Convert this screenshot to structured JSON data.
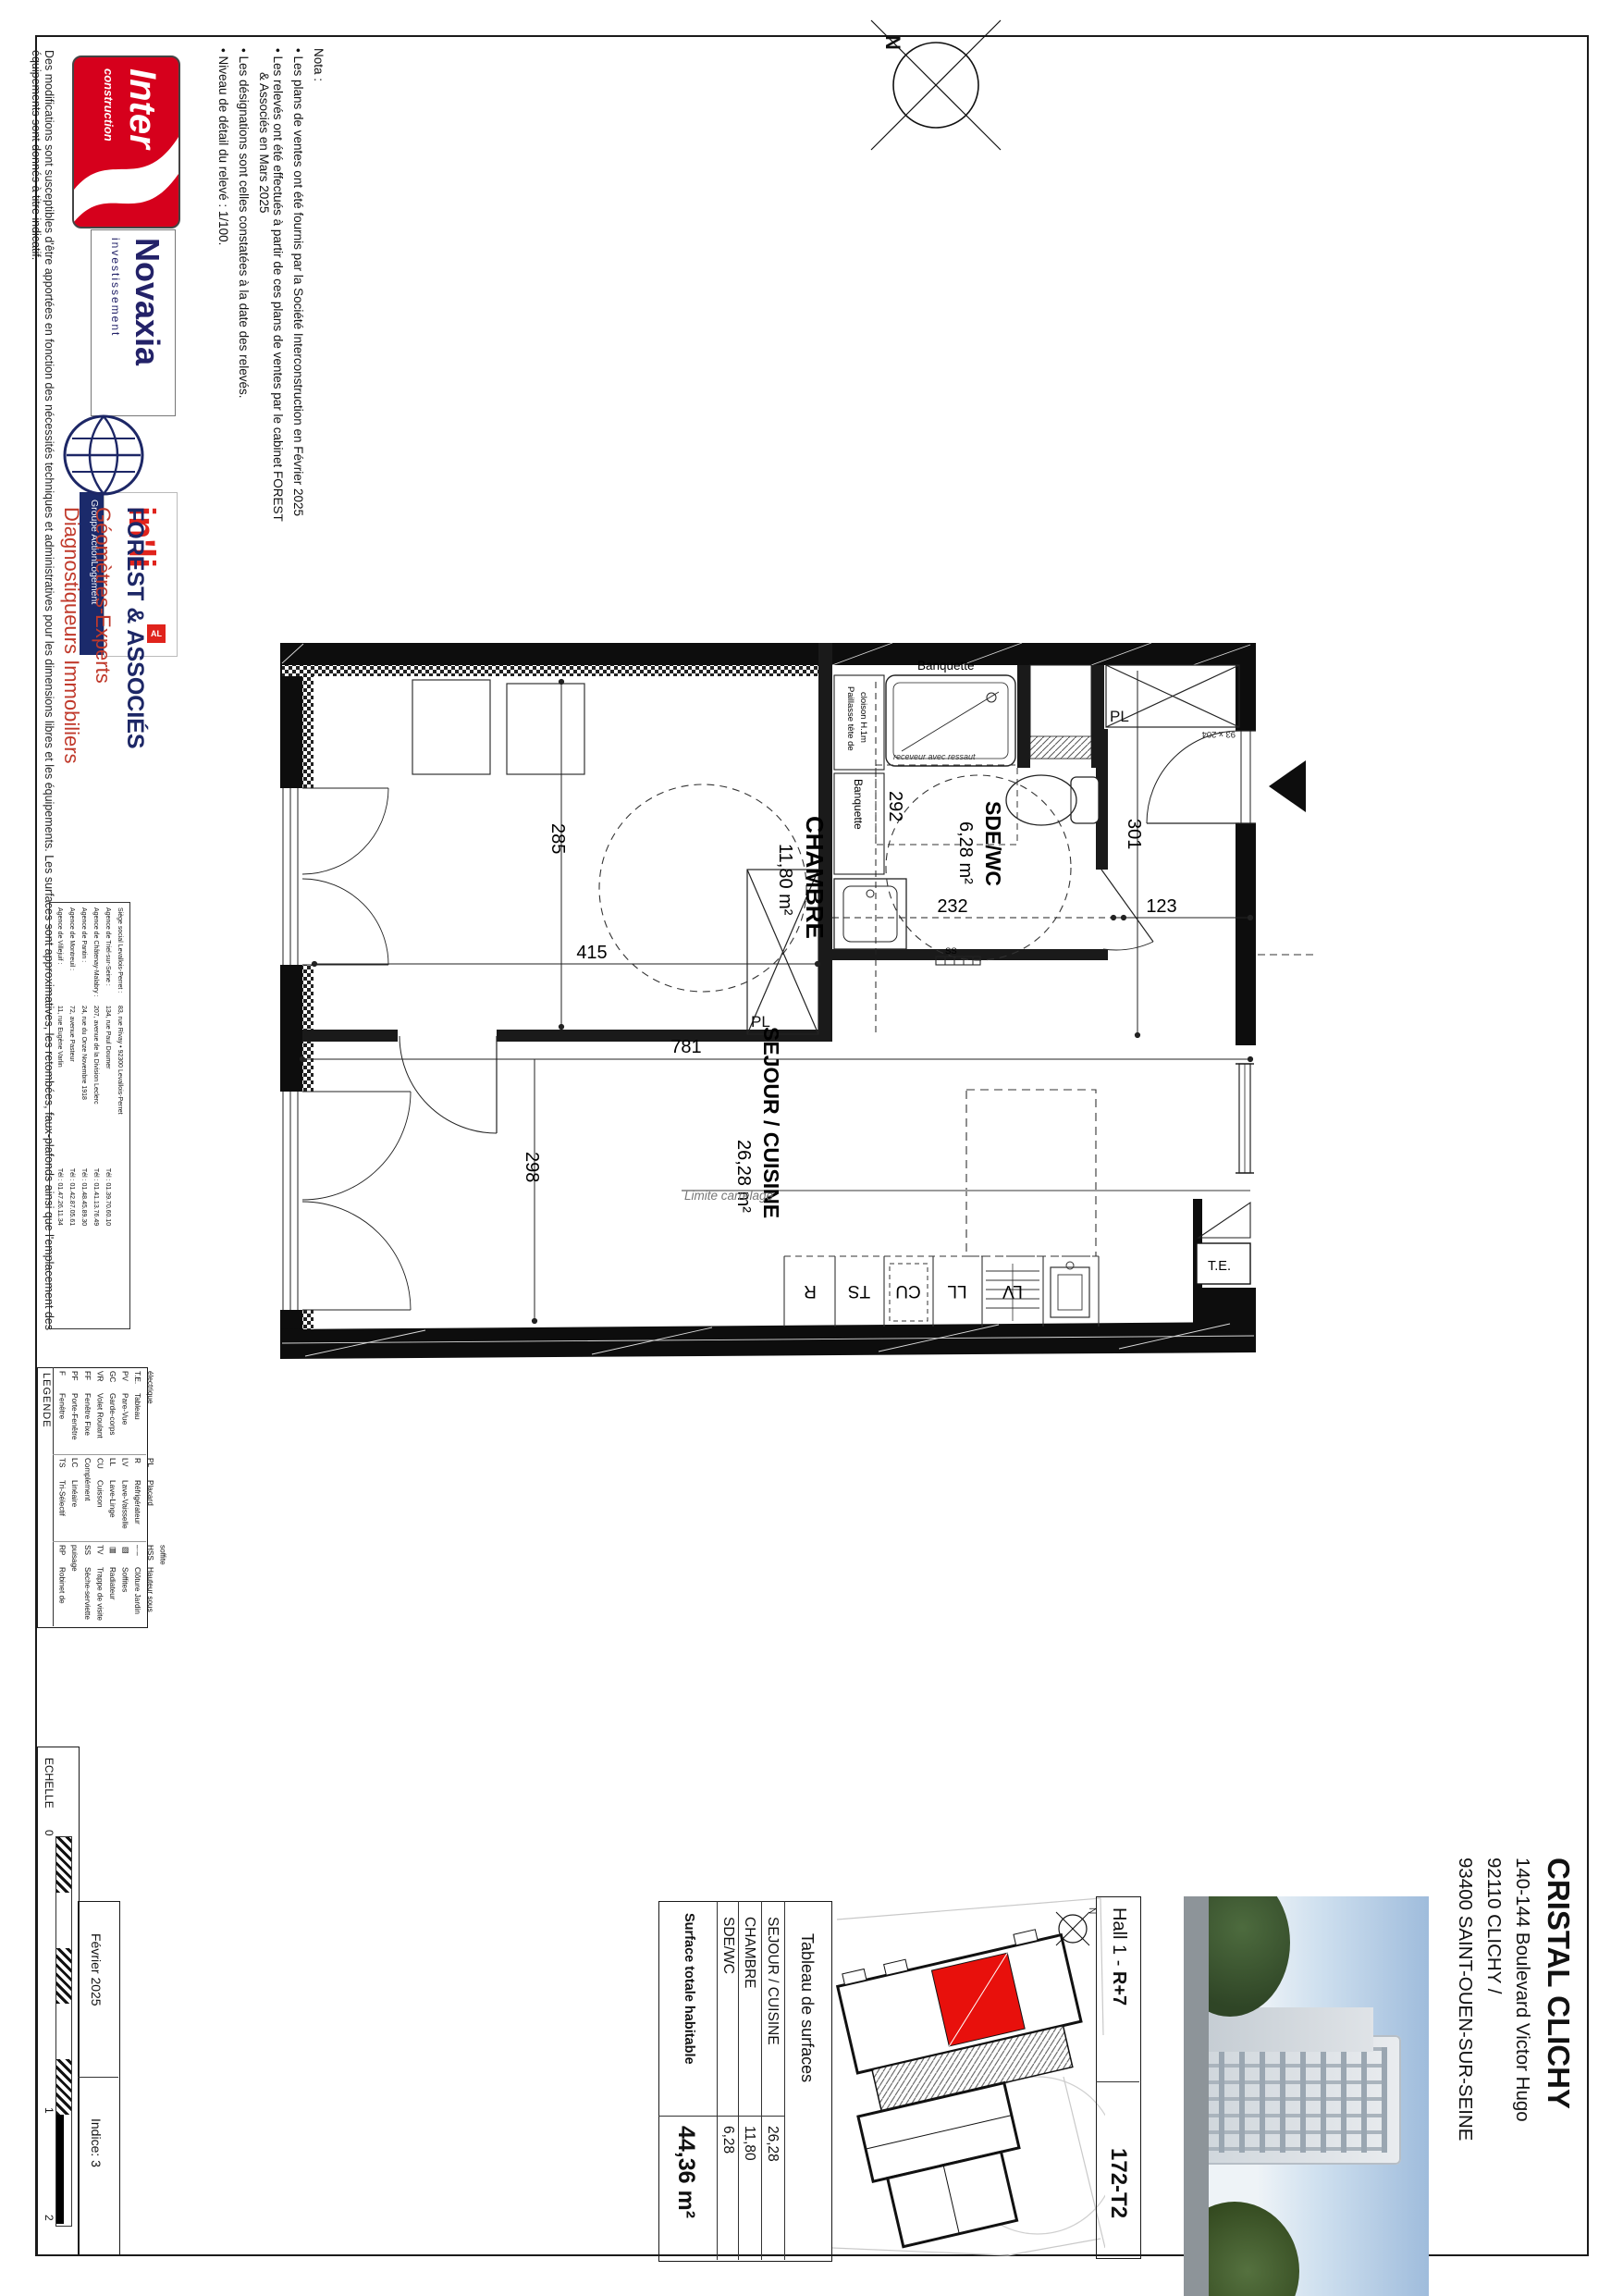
{
  "page": {
    "disclaimer": "Des modifications sont susceptibles d'être apportées en fonction des nécessités techniques et administratives pour les dimensions libres et les équipements. Les surfaces sont approximatives, les retombées, faux-plafonds ainsi que l'emplacement des équipements sont donnés à titre indicatif.",
    "scale_label": "ECHELLE",
    "scale_ticks": {
      "t0": "0",
      "t1": "1",
      "t2": "2"
    },
    "date": "Février 2025",
    "indice": "Indice: 3"
  },
  "logos": {
    "inter": {
      "line1": "Inter",
      "line2": "construction"
    },
    "novaxia": {
      "name": "Novaxia",
      "sub": "investissement"
    },
    "inli": {
      "name": "in'li",
      "al": "AL",
      "group": "Groupe ActionLogement"
    }
  },
  "nota": {
    "title": "Nota :",
    "b1": "•  Les plans de ventes ont été fournis par la Société Interconstruction en Février 2025",
    "b2a": "•  Les relevés ont été effectués à partir de ces plans de ventes par le cabinet FOREST",
    "b2b": "& Associés en Mars 2025",
    "b3": "•  Les désignations sont celles constatées à la date des relevés.",
    "b4": "•  Niveau de détail du relevé : 1/100."
  },
  "forest": {
    "name": "FOREST & ASSOCIÉS",
    "spec1": "Géomètres-Experts",
    "spec2": "Diagnostiqueurs Immobiliers",
    "agencies": [
      {
        "name": "Siège social Levallois-Perret :",
        "addr": "83, rue Rivay • 92300 Levallois-Perret",
        "tel": ""
      },
      {
        "name": "Agence de Triel-sur-Seine :",
        "addr": "134, rue Paul Doumer",
        "tel": "Tél :  01.39.70.60.10"
      },
      {
        "name": "Agence de Châtenay-Malabry :",
        "addr": "207, avenue de la Division Leclerc",
        "tel": "Tél :  01.41.13.76.49"
      },
      {
        "name": "Agence de Pantin :",
        "addr": "24, rue du Onze Novembre 1918",
        "tel": "Tél :  01.48.45.89.30"
      },
      {
        "name": "Agence de Montreuil :",
        "addr": "72, avenue Pasteur",
        "tel": "Tél :  01.42.87.05.61"
      },
      {
        "name": "Agence de Villejuif :",
        "addr": "11, rue Eugène Varlin",
        "tel": "Tél :  01.47.26.11.34"
      }
    ]
  },
  "legend": {
    "title": "LEGENDE",
    "g1": [
      {
        "a": "F",
        "n": "Fenêtre"
      },
      {
        "a": "PF",
        "n": "Porte-Fenêtre"
      },
      {
        "a": "FF",
        "n": "Fenêtre Fixe"
      },
      {
        "a": "VR",
        "n": "Volet Roulant"
      },
      {
        "a": "GC",
        "n": "Garde-corps"
      },
      {
        "a": "PV",
        "n": "Pare-Vue"
      },
      {
        "a": "T.E.",
        "n": "Tableau électrique"
      }
    ],
    "g2": [
      {
        "a": "TS",
        "n": "Tri-Sélectif"
      },
      {
        "a": "LC",
        "n": "Linéaire Complément"
      },
      {
        "a": "CU",
        "n": "Cuisson"
      },
      {
        "a": "LL",
        "n": "Lave-Linge"
      },
      {
        "a": "LV",
        "n": "Lave-Vaisselle"
      },
      {
        "a": "R",
        "n": "Réfrigérateur"
      },
      {
        "a": "PL",
        "n": "Placard"
      }
    ],
    "g3": [
      {
        "a": "RP",
        "n": "Robinet de puisage"
      },
      {
        "a": "SS",
        "n": "Sèche-serviette"
      },
      {
        "a": "TV",
        "n": "Trappe de visite"
      },
      {
        "a": "▤",
        "n": "Radiateur"
      },
      {
        "a": "▨",
        "n": "Soffites"
      },
      {
        "a": "–·–",
        "n": "Clôture Jardin"
      },
      {
        "a": "HSS",
        "n": "Hauteur sous soffite"
      }
    ]
  },
  "plan": {
    "rooms": {
      "chambre": {
        "name": "CHAMBRE",
        "area": "11,80 m²"
      },
      "sde": {
        "name": "SDE/WC",
        "area": "6,28 m²"
      },
      "sejour": {
        "name": "SEJOUR / CUISINE",
        "area": "26,28 m²"
      }
    },
    "dims": {
      "d285": "285",
      "d415": "415",
      "d292": "292",
      "d232": "232",
      "d123": "123",
      "d301": "301",
      "d781": "781",
      "d298": "298"
    },
    "labels": {
      "banquette_h": "Banquette",
      "banquette_v": "Banquette",
      "receveur": "receveur avec ressaut",
      "paillasse1": "Paillasse tête de",
      "paillasse2": "cloison H.1m",
      "limite": "Limite carrelage",
      "pl_entree": "PL",
      "pl_chambre": "PL",
      "te": "T.E.",
      "door_size": "93 x 204",
      "ss": "SS"
    },
    "appliances": [
      "R",
      "TS",
      "CU",
      "LL",
      "LV"
    ]
  },
  "surfaces": {
    "title": "Tableau de surfaces",
    "rows": [
      {
        "name": "SEJOUR / CUISINE",
        "value": "26,28"
      },
      {
        "name": "CHAMBRE",
        "value": "11,80"
      },
      {
        "name": "SDE/WC",
        "value": "6,28"
      }
    ],
    "total": {
      "name": "Surface totale habitable",
      "value": "44,36 m²"
    }
  },
  "titleblock": {
    "project": "CRISTAL CLICHY",
    "addr1": "140-144 Boulevard Victor Hugo",
    "addr2": "92110 CLICHY /",
    "addr3": "93400 SAINT-OUEN-SUR-SEINE",
    "hall_prefix": "Hall 1 - ",
    "hall_level": "R+7",
    "unit": "172-T2"
  },
  "compass": {
    "n": "N"
  }
}
